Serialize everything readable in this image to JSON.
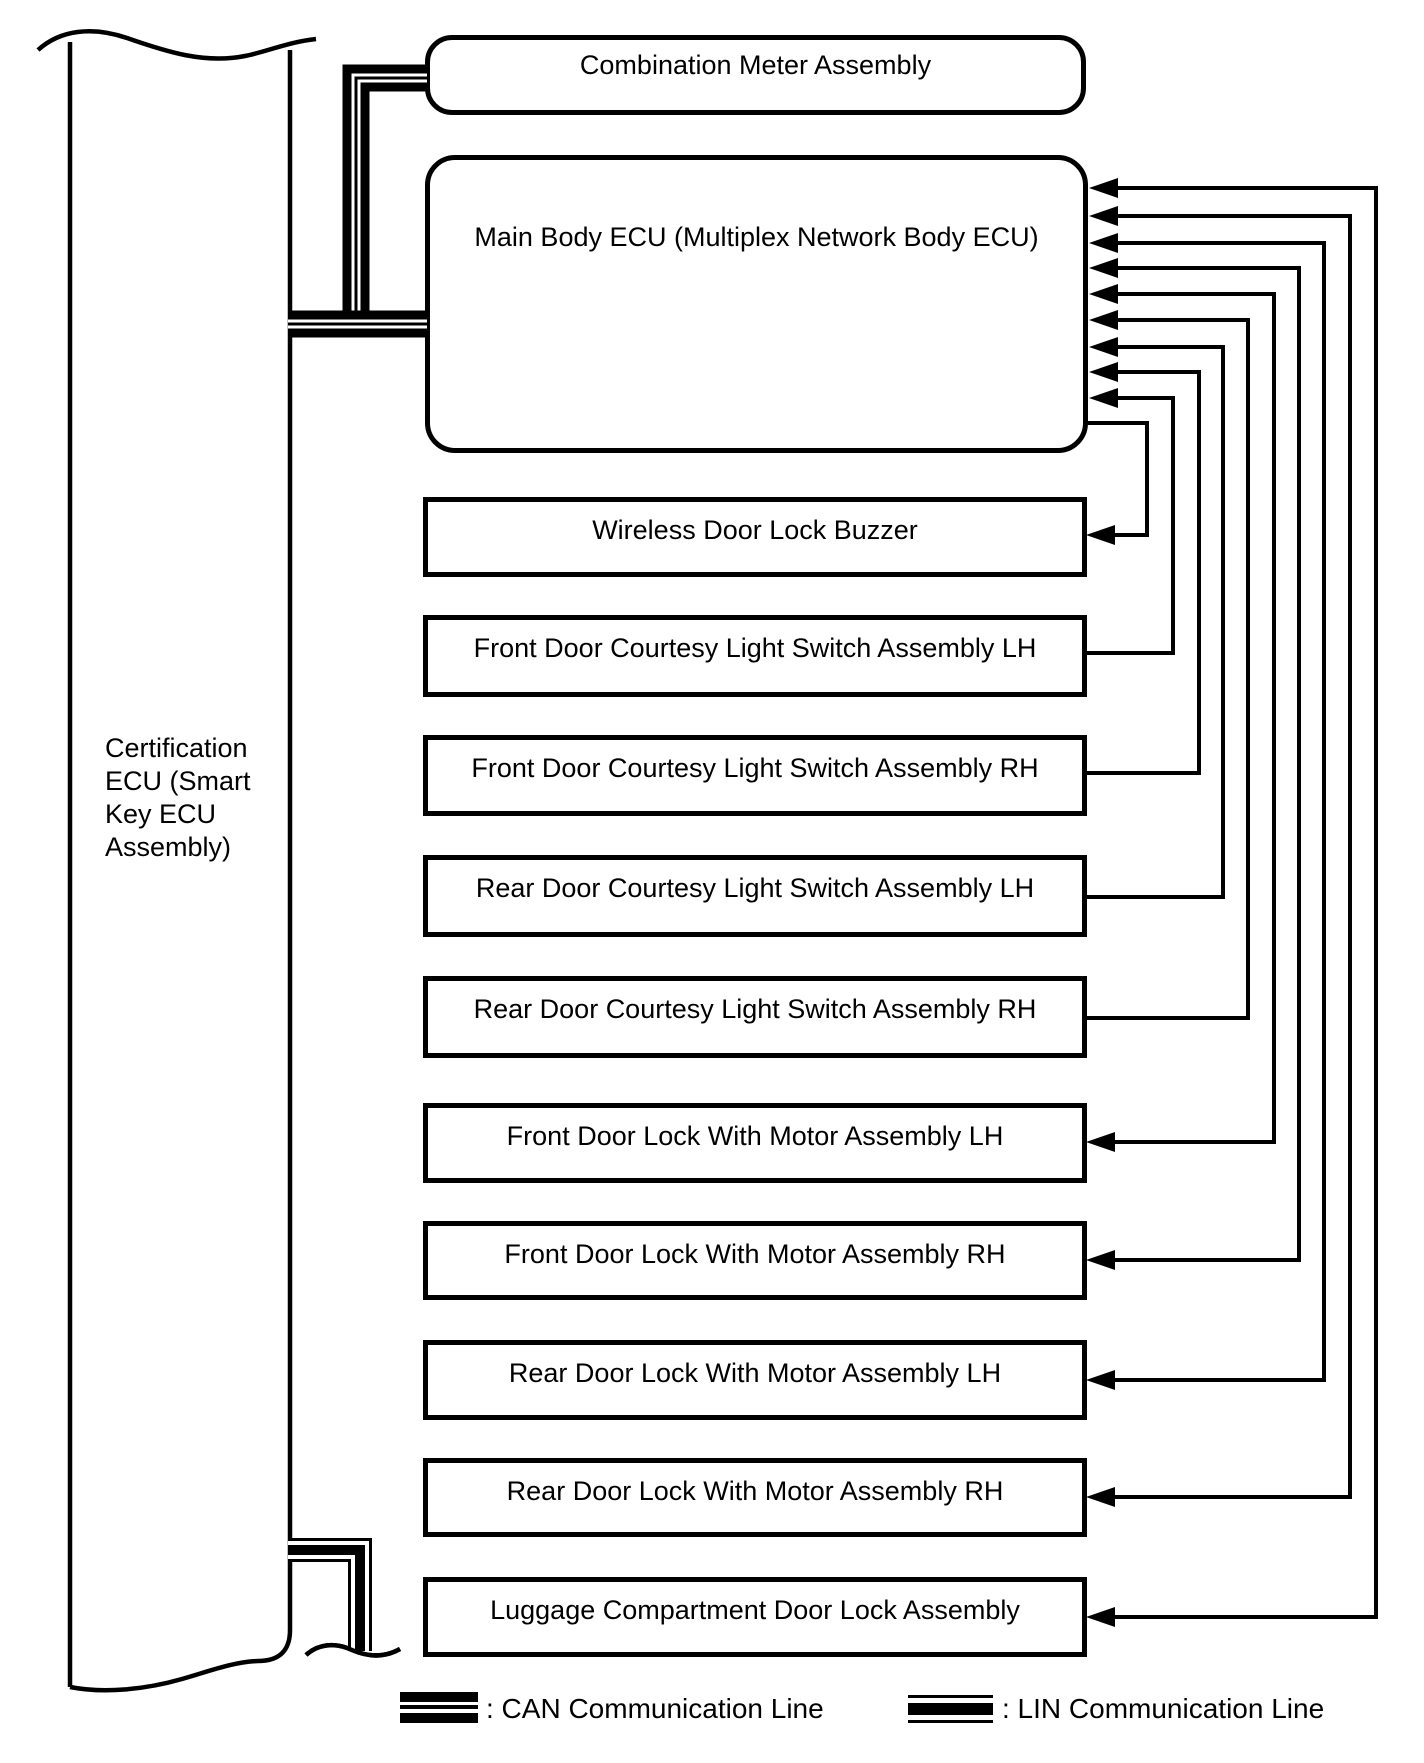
{
  "diagram_title": "Door lock control communication diagram",
  "nodes": {
    "certification_ecu": {
      "label": "Certification\nECU (Smart\nKey ECU\nAssembly)"
    },
    "combination_meter": {
      "label": "Combination Meter Assembly"
    },
    "main_body_ecu": {
      "label": "Main Body ECU (Multiplex Network Body ECU)"
    },
    "components": [
      {
        "id": "wireless-door-lock-buzzer",
        "label": "Wireless Door Lock Buzzer"
      },
      {
        "id": "front-door-courtesy-lh",
        "label": "Front Door Courtesy Light Switch Assembly LH"
      },
      {
        "id": "front-door-courtesy-rh",
        "label": "Front Door Courtesy Light Switch Assembly RH"
      },
      {
        "id": "rear-door-courtesy-lh",
        "label": "Rear Door Courtesy Light Switch Assembly LH"
      },
      {
        "id": "rear-door-courtesy-rh",
        "label": "Rear Door Courtesy Light Switch Assembly RH"
      },
      {
        "id": "front-door-lock-lh",
        "label": "Front Door Lock With Motor Assembly LH"
      },
      {
        "id": "front-door-lock-rh",
        "label": "Front Door Lock With Motor Assembly RH"
      },
      {
        "id": "rear-door-lock-lh",
        "label": "Rear Door Lock With Motor Assembly LH"
      },
      {
        "id": "rear-door-lock-rh",
        "label": "Rear Door Lock With Motor Assembly RH"
      },
      {
        "id": "luggage-door-lock",
        "label": "Luggage Compartment Door Lock Assembly"
      }
    ]
  },
  "connections": [
    {
      "from": "certification-ecu",
      "to": "combination-meter",
      "bus": "CAN"
    },
    {
      "from": "certification-ecu",
      "to": "main-body-ecu",
      "bus": "CAN"
    },
    {
      "from": "certification-ecu",
      "to": "off-diagram (break)",
      "bus": "LIN"
    },
    {
      "from": "main-body-ecu",
      "to": "wireless-door-lock-buzzer",
      "direction": "to-component"
    },
    {
      "from": "front-door-courtesy-lh",
      "to": "main-body-ecu",
      "direction": "to-ecu"
    },
    {
      "from": "front-door-courtesy-rh",
      "to": "main-body-ecu",
      "direction": "to-ecu"
    },
    {
      "from": "rear-door-courtesy-lh",
      "to": "main-body-ecu",
      "direction": "to-ecu"
    },
    {
      "from": "rear-door-courtesy-rh",
      "to": "main-body-ecu",
      "direction": "to-ecu"
    },
    {
      "from": "main-body-ecu",
      "to": "front-door-lock-lh",
      "direction": "bidirectional"
    },
    {
      "from": "main-body-ecu",
      "to": "front-door-lock-rh",
      "direction": "bidirectional"
    },
    {
      "from": "main-body-ecu",
      "to": "rear-door-lock-lh",
      "direction": "bidirectional"
    },
    {
      "from": "main-body-ecu",
      "to": "rear-door-lock-rh",
      "direction": "bidirectional"
    },
    {
      "from": "main-body-ecu",
      "to": "luggage-door-lock",
      "direction": "bidirectional"
    }
  ],
  "legend": [
    {
      "id": "can",
      "label": ": CAN Communication Line"
    },
    {
      "id": "lin",
      "label": ": LIN Communication Line"
    }
  ],
  "colors": {
    "foreground": "#000000",
    "background": "#ffffff"
  }
}
